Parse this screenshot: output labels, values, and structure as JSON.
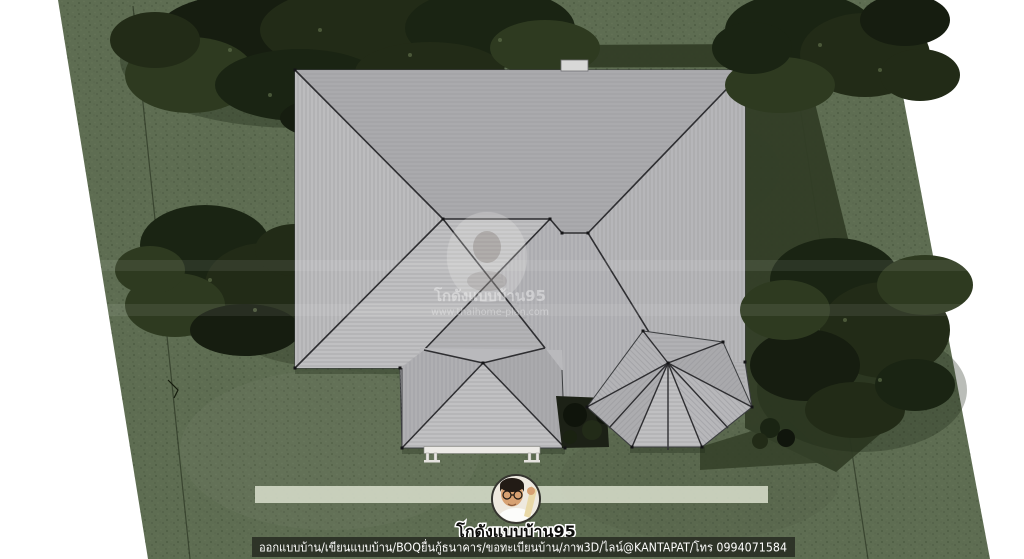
{
  "branding": {
    "avatar": "portrait-photo",
    "name": "โกดังแบบบ้าน95"
  },
  "caption_bar": {
    "text": "ออกแบบบ้าน/เขียนแบบบ้าน/BOQยื่นกู้ธนาคาร/ขอทะเบียนบ้าน/ภาพ3D/ไลน์@KANTAPAT/โทร 0994071584"
  },
  "watermark": {
    "name": "โกดังแบบบ้าน95",
    "url": "www.thaihome-plan.com"
  },
  "palette": {
    "background": "#ffffff",
    "lawn": "#5e6d52",
    "lawn_shadow": "#313d26",
    "foliage_dark": "#1a2413",
    "roof_base": "#b3b3b6",
    "roof_light": "#c0c0c2",
    "roof_dark": "#a9a9ac",
    "ridge_line": "#2e2e31",
    "highlight_band": "#d3d9c7",
    "caption_bar_bg": "#2b2f25"
  }
}
